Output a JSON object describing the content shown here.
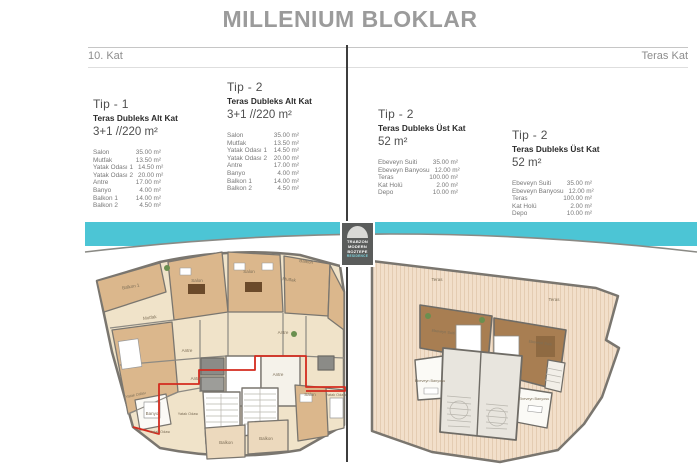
{
  "title": "MILLENIUM BLOKLAR",
  "header": {
    "left_label": "10. Kat",
    "right_label": "Teras Kat"
  },
  "specs": [
    {
      "type": "Tip - 1",
      "subtitle": "Teras Dubleks Alt Kat",
      "size": "3+1 //220 m²",
      "rooms": [
        {
          "name": "Salon",
          "area": "35.00 m²"
        },
        {
          "name": "Mutfak",
          "area": "13.50 m²"
        },
        {
          "name": "Yatak Odası 1",
          "area": "14.50 m²"
        },
        {
          "name": "Yatak Odası 2",
          "area": "20.00 m²"
        },
        {
          "name": "Antre",
          "area": "17.00 m²"
        },
        {
          "name": "Banyo",
          "area": "4.00 m²"
        },
        {
          "name": "Balkon 1",
          "area": "14.00 m²"
        },
        {
          "name": "Balkon 2",
          "area": "4.50 m²"
        }
      ]
    },
    {
      "type": "Tip - 2",
      "subtitle": "Teras Dubleks Alt Kat",
      "size": "3+1 //220 m²",
      "rooms": [
        {
          "name": "Salon",
          "area": "35.00 m²"
        },
        {
          "name": "Mutfak",
          "area": "13.50 m²"
        },
        {
          "name": "Yatak Odası 1",
          "area": "14.50 m²"
        },
        {
          "name": "Yatak Odası 2",
          "area": "20.00 m²"
        },
        {
          "name": "Antre",
          "area": "17.00 m²"
        },
        {
          "name": "Banyo",
          "area": "4.00 m²"
        },
        {
          "name": "Balkon 1",
          "area": "14.00 m²"
        },
        {
          "name": "Balkon 2",
          "area": "4.50 m²"
        }
      ]
    },
    {
      "type": "Tip - 2",
      "subtitle": "Teras Dubleks Üst Kat",
      "size": "52 m²",
      "rooms": [
        {
          "name": "Ebeveyn Suiti",
          "area": "35.00 m²"
        },
        {
          "name": "Ebeveyn Banyosu",
          "area": "12.00 m²"
        },
        {
          "name": "Teras",
          "area": "100.00 m²"
        },
        {
          "name": "Kat Holü",
          "area": "2.00 m²"
        },
        {
          "name": "Depo",
          "area": "10.00 m²"
        }
      ]
    },
    {
      "type": "Tip - 2",
      "subtitle": "Teras Dubleks Üst Kat",
      "size": "52 m²",
      "rooms": [
        {
          "name": "Ebeveyn Suiti",
          "area": "35.00 m²"
        },
        {
          "name": "Ebeveyn Banyosu",
          "area": "12.00 m²"
        },
        {
          "name": "Teras",
          "area": "100.00 m²"
        },
        {
          "name": "Kat Holü",
          "area": "2.00 m²"
        },
        {
          "name": "Depo",
          "area": "10.00 m²"
        }
      ]
    }
  ],
  "logo": {
    "lines": [
      "TRABZON",
      "MODERN",
      "BOZTEPE",
      "RESIDENCE"
    ]
  },
  "floorplans": {
    "left": {
      "labels": [
        "Balkon 1",
        "Salon",
        "Salon",
        "Mutfak",
        "Balkon",
        "Mutfak",
        "Antre",
        "Antre",
        "Antre",
        "Antre",
        "Yatak Odası",
        "Banyo",
        "Yatak Odası",
        "Yatak Odası",
        "Salon",
        "Yatak Odası",
        "Balkon",
        "Balkon"
      ]
    },
    "right": {
      "labels": [
        "Teras",
        "Teras",
        "Ebeveyn Suiti",
        "Ebeveyn Suiti",
        "Ebeveyn Banyosu",
        "Ebeveyn Banyosu"
      ]
    }
  },
  "colors": {
    "accent_cyan": "#4cc5d5",
    "highlight_red": "#d42b1e",
    "terrace_peach": "#f2dfca",
    "room_tan": "#dbb78c",
    "suite_brown": "#a87e52"
  }
}
